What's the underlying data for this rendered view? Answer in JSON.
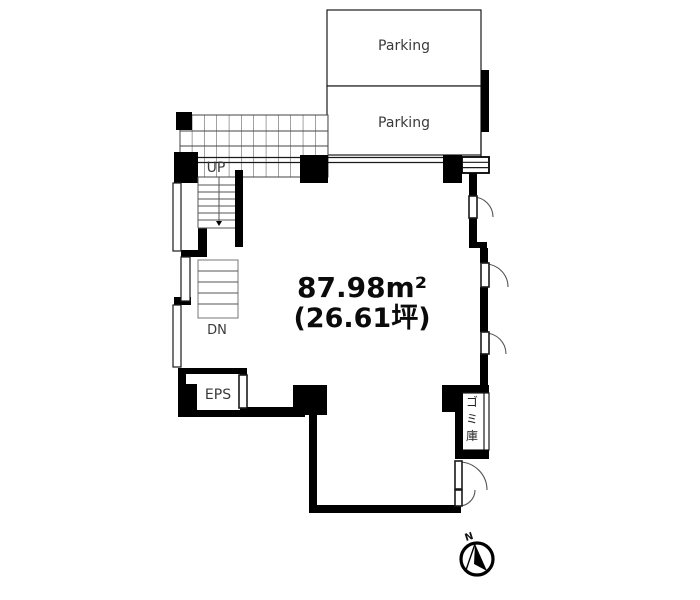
{
  "plan": {
    "parking_upper_label": "Parking",
    "parking_lower_label": "Parking",
    "stairs_up_label": "UP",
    "stairs_down_label": "DN",
    "eps_label": "EPS",
    "area_sqm": "87.98m²",
    "area_tsubo": "(26.61坪)",
    "garbage_room_label": "ゴミ庫",
    "garbage_chars": [
      "ゴ",
      "ミ",
      "庫"
    ],
    "compass_north_label": "N"
  },
  "colors": {
    "background": "#ffffff",
    "wall": "#000000",
    "label_text": "#3a3a3a",
    "area_text": "#0b0b0b",
    "door_arc": "#555555"
  }
}
